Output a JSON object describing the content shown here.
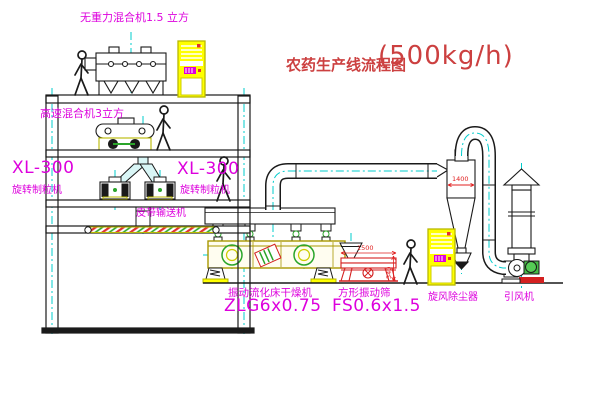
{
  "title": {
    "text": "农药生产线流程图",
    "capacity": "(500kg/h)"
  },
  "labels": {
    "mixer_top": "无重力混合机1.5 立方",
    "mixer_mid": "高速混合机3立方",
    "granulator_left_model": "XL-300",
    "granulator_left_name": "旋转制粒机",
    "granulator_right_model": "XL-300",
    "granulator_right_name": "旋转制粒机",
    "conveyor": "皮带输送机",
    "dryer_name": "振动流化床干燥机",
    "dryer_model": "ZLG6x0.75",
    "screen_name": "方形振动筛",
    "screen_model": "FS0.6x1.5",
    "cyclone": "旋风除尘器",
    "fan": "引风机"
  },
  "dimensions": {
    "cyclone": "1400",
    "screen_length": "1500",
    "screen_height": "540"
  },
  "colors": {
    "label_magenta": "#dd00dd",
    "title_red": "#cc4040",
    "dim_red": "#e02020",
    "line_black": "#1a1a1a",
    "equipment_yellow": "#ffff00",
    "centerline_cyan": "#00cccc",
    "valve_green": "#2aa52a",
    "screen_red": "#d42020"
  }
}
